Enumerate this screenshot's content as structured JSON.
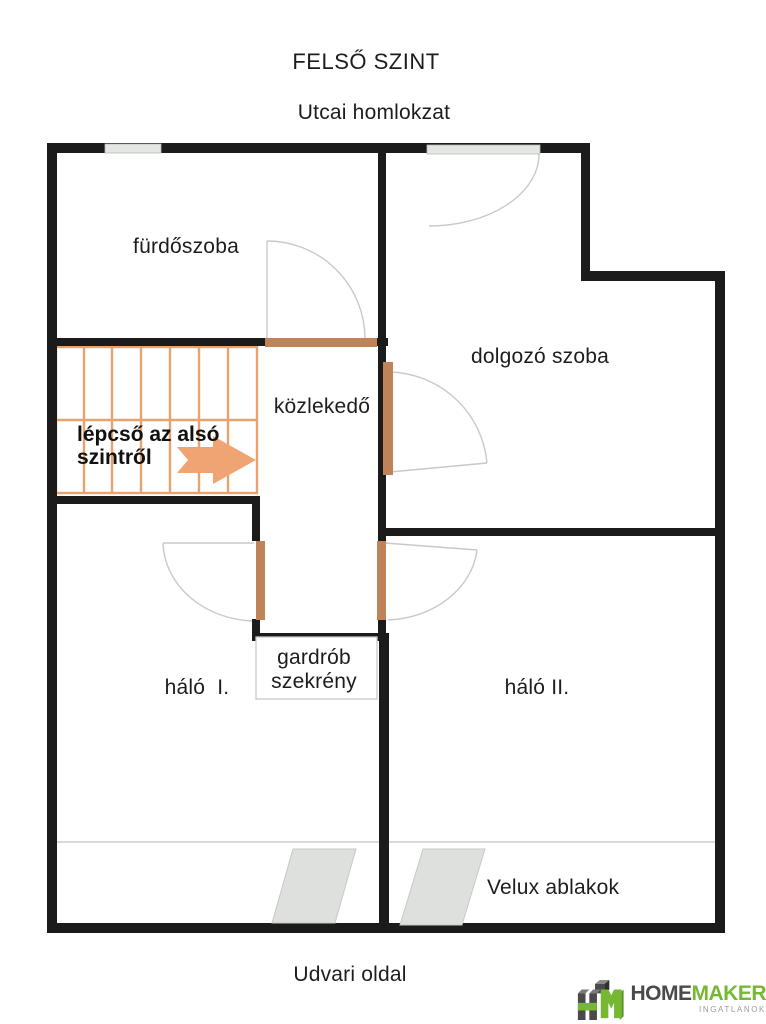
{
  "page": {
    "title": "FELSŐ SZINT",
    "subtitle": "Utcai homlokzat",
    "footer": "Udvari oldal"
  },
  "rooms": {
    "bathroom": "fürdőszoba",
    "study": "dolgozó szoba",
    "hallway": "közlekedő",
    "bedroom1": "háló  I.",
    "bedroom2": "háló II.",
    "wardrobe_line1": "gardrób",
    "wardrobe_line2": "szekrény",
    "velux_label": "Velux ablakok"
  },
  "stairs": {
    "note_line1": "lépcső az alsó",
    "note_line2": "szintről"
  },
  "logo": {
    "brand_dark": "HOME",
    "brand_green": "MAKER",
    "tagline": "INGATLANOK"
  },
  "colors": {
    "wall": "#1b1b1b",
    "stairs_line": "#e8a26e",
    "arrow": "#f0a474",
    "door_jamb": "#c08358",
    "door_arc": "#c9c9c9",
    "window_fill": "#e4e6e3",
    "velux_fill": "#dde0dc",
    "logo_green": "#76b832",
    "logo_gray": "#4a4a4a"
  }
}
